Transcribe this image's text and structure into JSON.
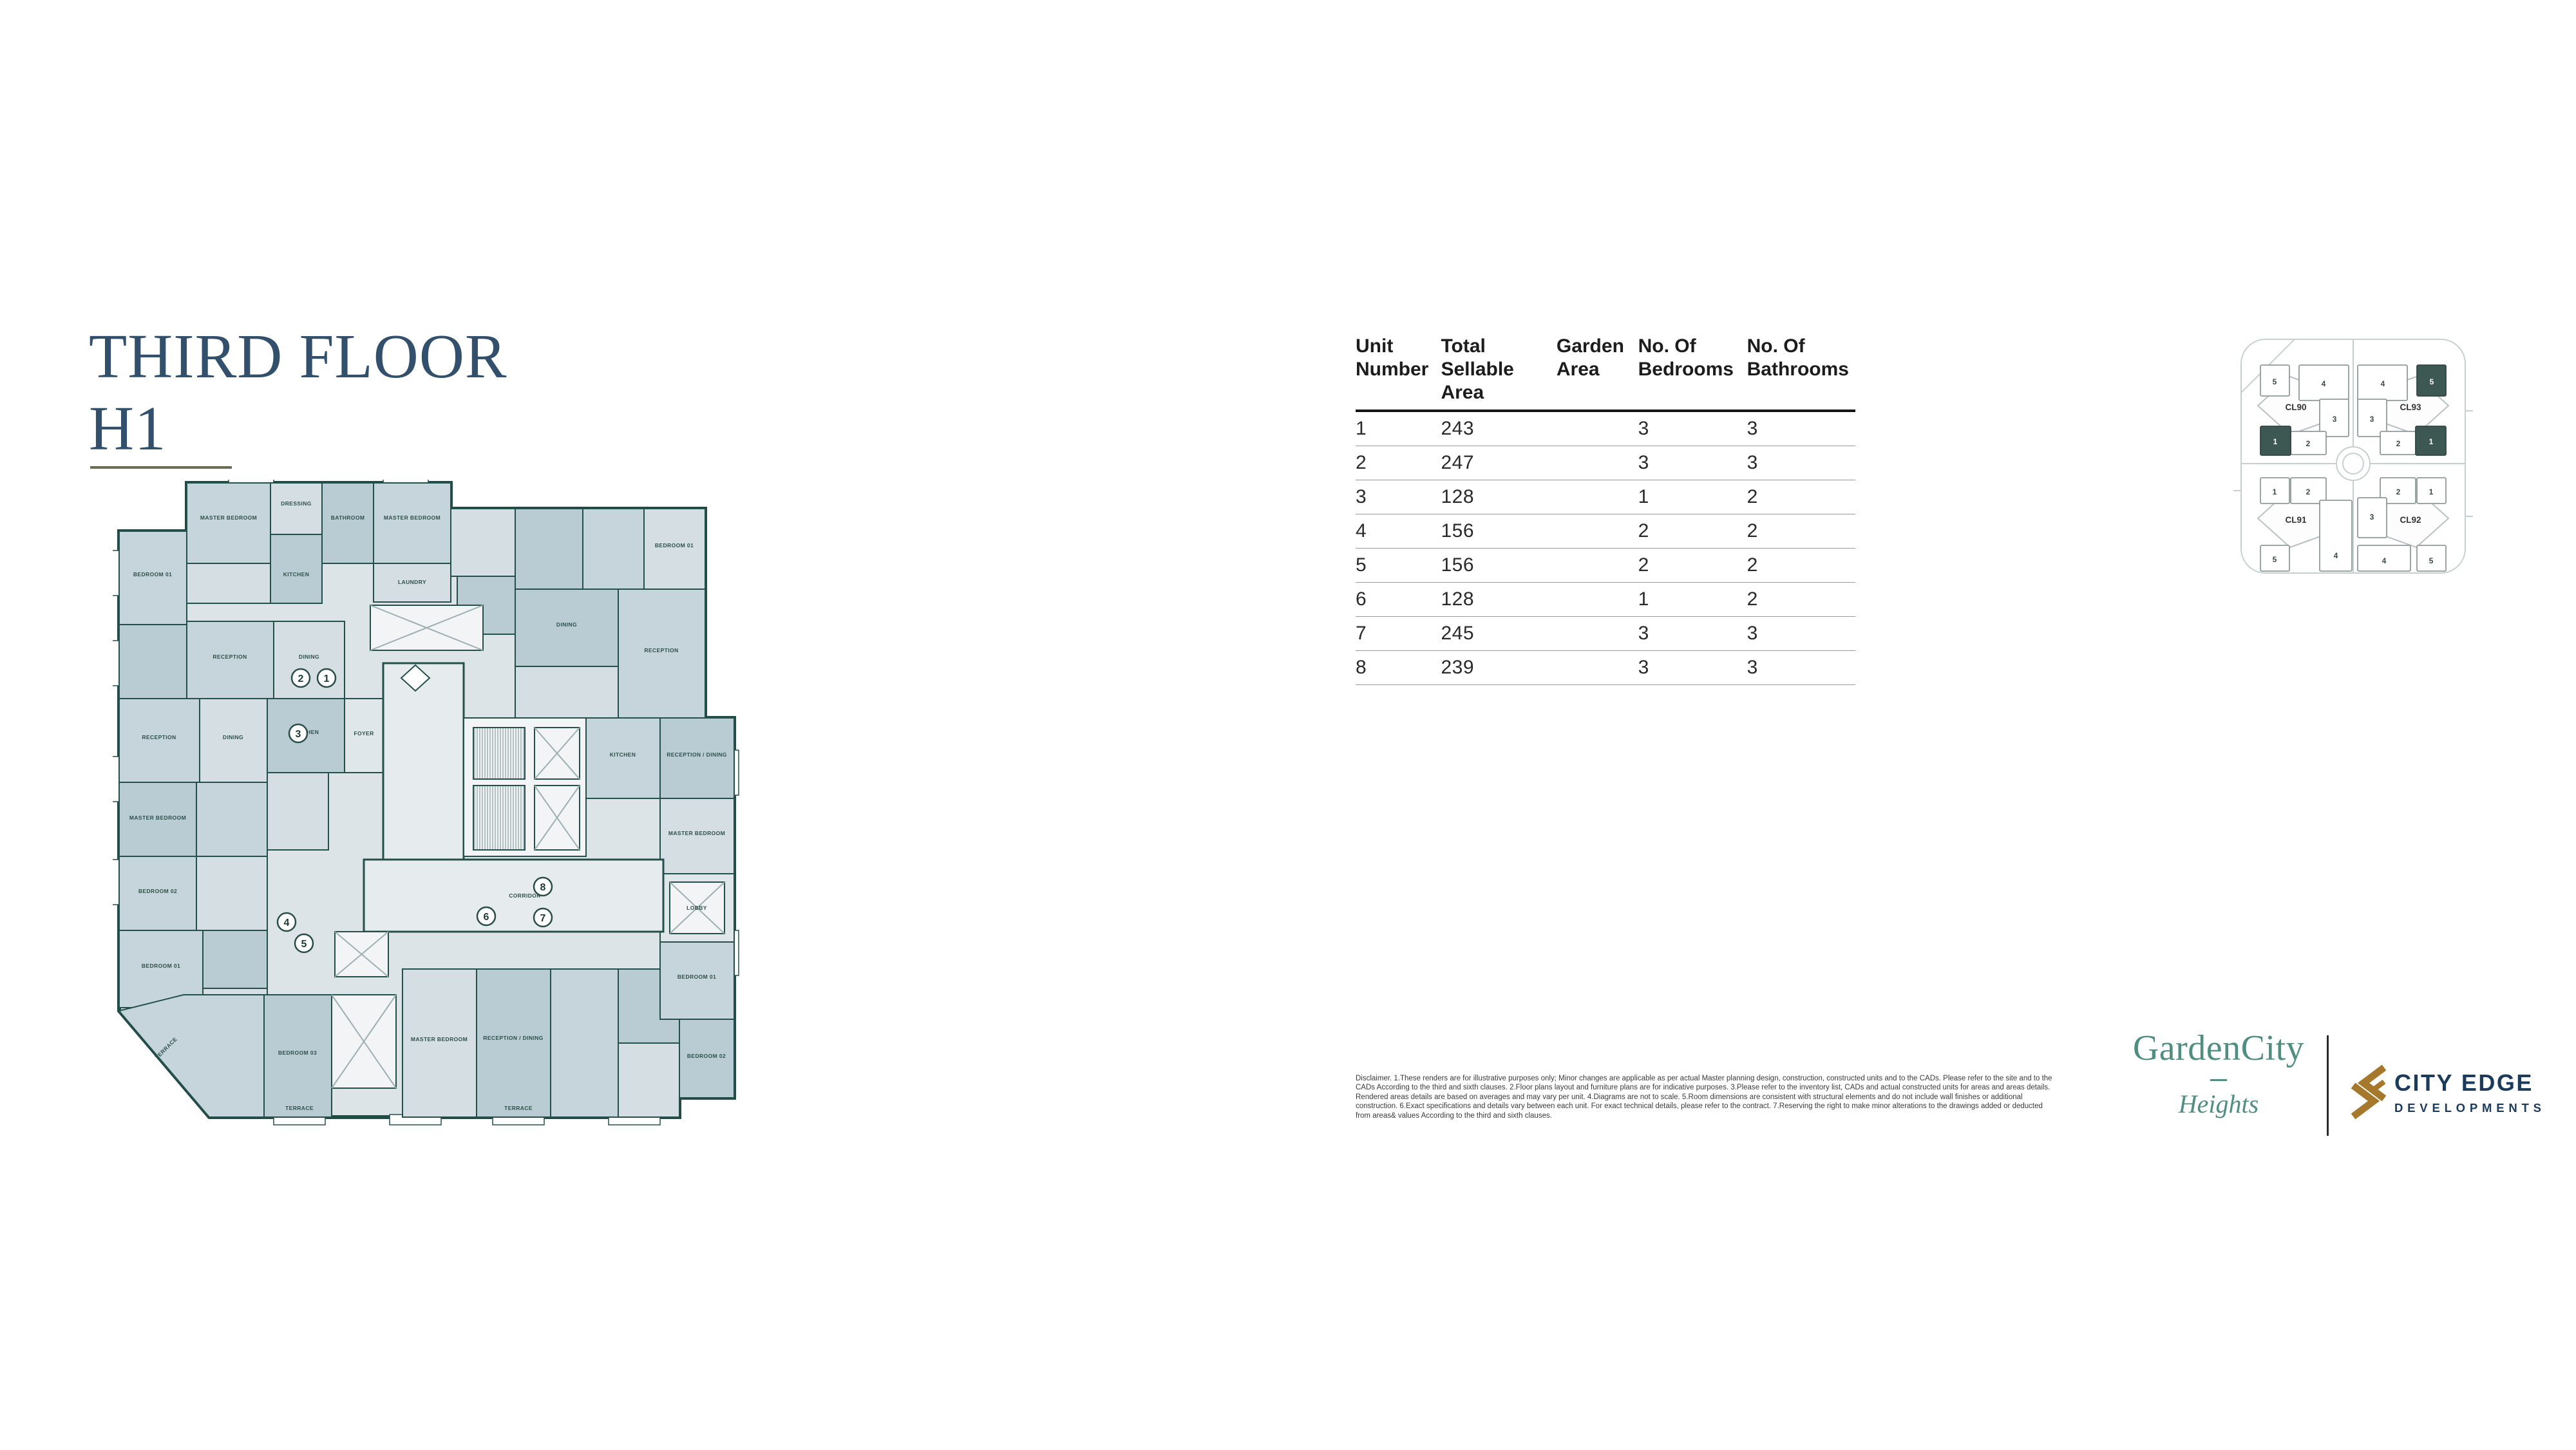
{
  "title": {
    "line1": "THIRD FLOOR",
    "line2": "H1"
  },
  "colors": {
    "title_navy": "#32506b",
    "underline_olive": "#6e6b54",
    "plan_wall_teal": "#24504b",
    "plan_room_blue": "#c6d5db",
    "brand_teal": "#4f8e81",
    "cityedge_navy": "#1c3b5c",
    "cityedge_gold": "#a5782b",
    "sitemap_highlight": "#3d5852"
  },
  "table": {
    "headers": [
      "Unit Number",
      "Total Sellable Area",
      "Garden Area",
      "No. Of Bedrooms",
      "No. Of Bathrooms"
    ],
    "rows": [
      [
        "1",
        "243",
        "",
        "3",
        "3"
      ],
      [
        "2",
        "247",
        "",
        "3",
        "3"
      ],
      [
        "3",
        "128",
        "",
        "1",
        "2"
      ],
      [
        "4",
        "156",
        "",
        "2",
        "2"
      ],
      [
        "5",
        "156",
        "",
        "2",
        "2"
      ],
      [
        "6",
        "128",
        "",
        "1",
        "2"
      ],
      [
        "7",
        "245",
        "",
        "3",
        "3"
      ],
      [
        "8",
        "239",
        "",
        "3",
        "3"
      ]
    ]
  },
  "floorplan": {
    "units": [
      "1",
      "2",
      "3",
      "4",
      "5",
      "6",
      "7",
      "8"
    ],
    "room_labels": [
      "MASTER BEDROOM",
      "DRESSING",
      "BATHROOM",
      "MASTER BEDROOM",
      "BEDROOM 01",
      "LAUNDRY",
      "KITCHEN",
      "RECEPTION",
      "DINING",
      "BEDROOM 01",
      "RECEPTION",
      "DINING",
      "FOYER",
      "RECEPTION",
      "DINING",
      "KITCHEN",
      "MASTER BEDROOM",
      "BEDROOM 02",
      "BEDROOM 01",
      "CORRIDOR",
      "RECEPTION / DINING",
      "MASTER BEDROOM",
      "BEDROOM 03",
      "TERRACE",
      "TERRACE",
      "RECEPTION / DINING",
      "MASTER BEDROOM",
      "LOBBY",
      "BEDROOM 01",
      "BEDROOM 02",
      "KITCHEN",
      "TERRACE"
    ]
  },
  "site_map": {
    "clusters": [
      {
        "label": "CL90",
        "buildings": [
          "5",
          "4",
          "3",
          "2",
          "1"
        ]
      },
      {
        "label": "CL93",
        "buildings": [
          "4",
          "5",
          "3",
          "2",
          "1"
        ]
      },
      {
        "label": "CL91",
        "buildings": [
          "1",
          "2",
          "5",
          "4"
        ]
      },
      {
        "label": "CL92",
        "buildings": [
          "2",
          "1",
          "3",
          "4",
          "5"
        ]
      }
    ]
  },
  "footer": {
    "disclaimer": "Disclaimer. 1.These renders are for illustrative purposes only; Minor changes are applicable as per actual Master planning design, construction, constructed units and to the CADs. Please refer to the site and to the CADs According to the third and sixth clauses. 2.Floor plans layout and furniture plans are for indicative purposes. 3.Please refer to the inventory list, CADs and actual constructed units for areas and areas details. Rendered areas details are based on averages and may vary per unit. 4.Diagrams are not to scale. 5.Room dimensions are consistent with structural elements and do not include wall finishes or additional construction. 6.Exact specifications and details vary between each unit. For exact technical details, please refer to the contract. 7.Reserving the right to make minor alterations to the drawings added or deducted from areas& values According to the third and sixth clauses.",
    "gardencity_name": "GardenCity",
    "gardencity_sub": "Heights",
    "cityedge_line1": "CITY EDGE",
    "cityedge_line2": "DEVELOPMENTS"
  }
}
